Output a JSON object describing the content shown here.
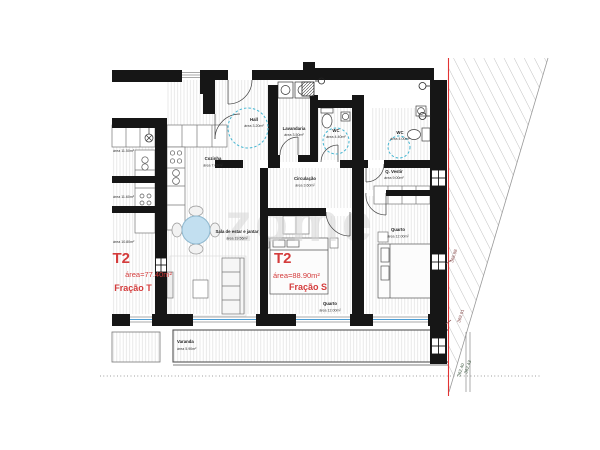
{
  "document": {
    "type": "architectural floor plan"
  },
  "watermark": "zome",
  "units": {
    "fracao_t": {
      "title": "T2",
      "area_label": "área=77.40m²",
      "name": "Fração T",
      "room_areas": [
        "área 11.50m²",
        "área 11.60m²",
        "área 10.80m²"
      ]
    },
    "fracao_s": {
      "title": "T2",
      "area_label": "área=88.90m²",
      "name": "Fração S"
    }
  },
  "rooms": {
    "hall": {
      "name": "Hall",
      "area": "área 3.20m²"
    },
    "lavandaria": {
      "name": "Lavandaria",
      "area": "área 3.50m²"
    },
    "wc_1": {
      "name": "WC",
      "area": "área 4.40m²"
    },
    "wc_2": {
      "name": "WC",
      "area": "área 4.00m²"
    },
    "circulacao": {
      "name": "Circulação",
      "area": "área 3.60m²"
    },
    "cozinha": {
      "name": "Cozinha",
      "area": "área 7.08m²"
    },
    "sala": {
      "name": "Sala de estar e jantar",
      "area": "área 19.56m²"
    },
    "quarto_meio": {
      "name": "Quarto",
      "area": "área 12.00m²"
    },
    "quarto_dir": {
      "name": "Quarto",
      "area": "área 12.00m²"
    },
    "vestir": {
      "name": "Q. Vestir",
      "area": "área 9.00m²"
    },
    "varanda": {
      "name": "Varanda",
      "area": "área 5.90m²"
    }
  },
  "elevation_marks": {
    "m1": "368.88",
    "m2": "369.91",
    "m3": "362.40",
    "m4": "362.43"
  },
  "colors": {
    "wall": "#161616",
    "accent_red": "#d43c3c",
    "boundary_red": "#e23333",
    "circle_teal": "#45b6d2",
    "table_blue": "#c2dff0",
    "window_blue": "#4d9fd6",
    "hatch_gray": "#bbbbbb",
    "floor_line": "#e3e3e3",
    "watermark_gray": "#d7d7d7"
  }
}
